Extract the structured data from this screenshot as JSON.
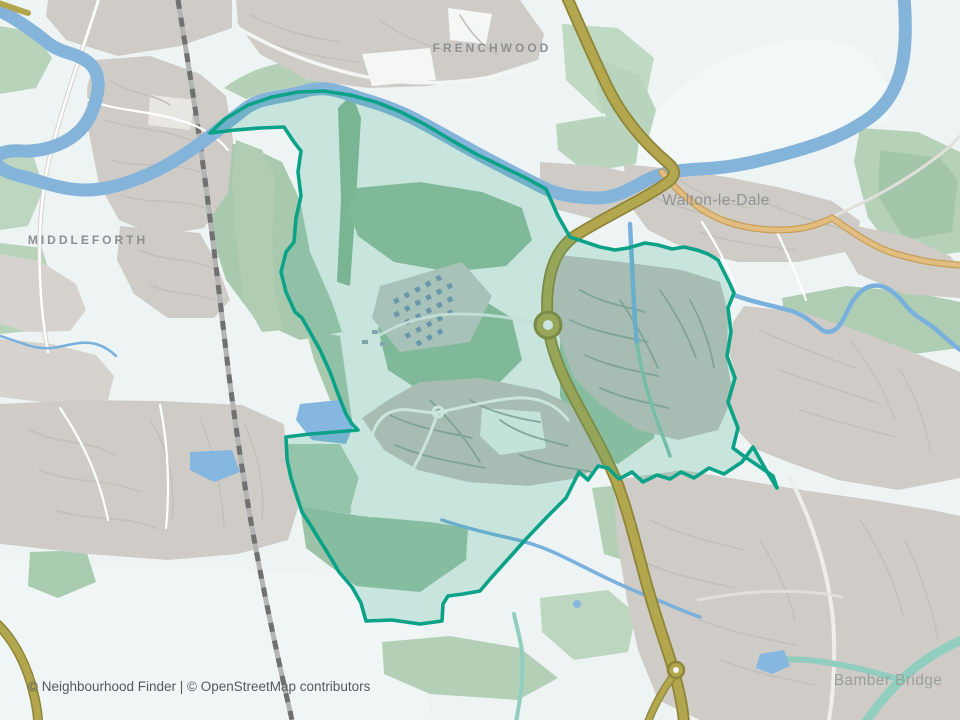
{
  "labels": {
    "frenchwood": "FRENCHWOOD",
    "middleforth": "MIDDLEFORTH",
    "walton": "Walton-le-Dale",
    "bamber": "Bamber Bridge"
  },
  "attribution": {
    "text": "© Neighbourhood Finder | © OpenStreetMap contributors"
  },
  "boundary": {
    "role": "highlighted neighbourhood outline"
  },
  "colors": {
    "background": "#eef4f3",
    "boundary_stroke": "#0ba287",
    "boundary_fill": "rgba(44,165,135,0.20)",
    "water": "#85b4da",
    "stream_teal": "#92cebf",
    "road_major": "#b2a64e",
    "road_major_casing": "#8e8539",
    "road_secondary": "#e2bd80",
    "urban": "#cfccc8",
    "green": "#a9c9ae",
    "railway": "#9b9b9b"
  }
}
